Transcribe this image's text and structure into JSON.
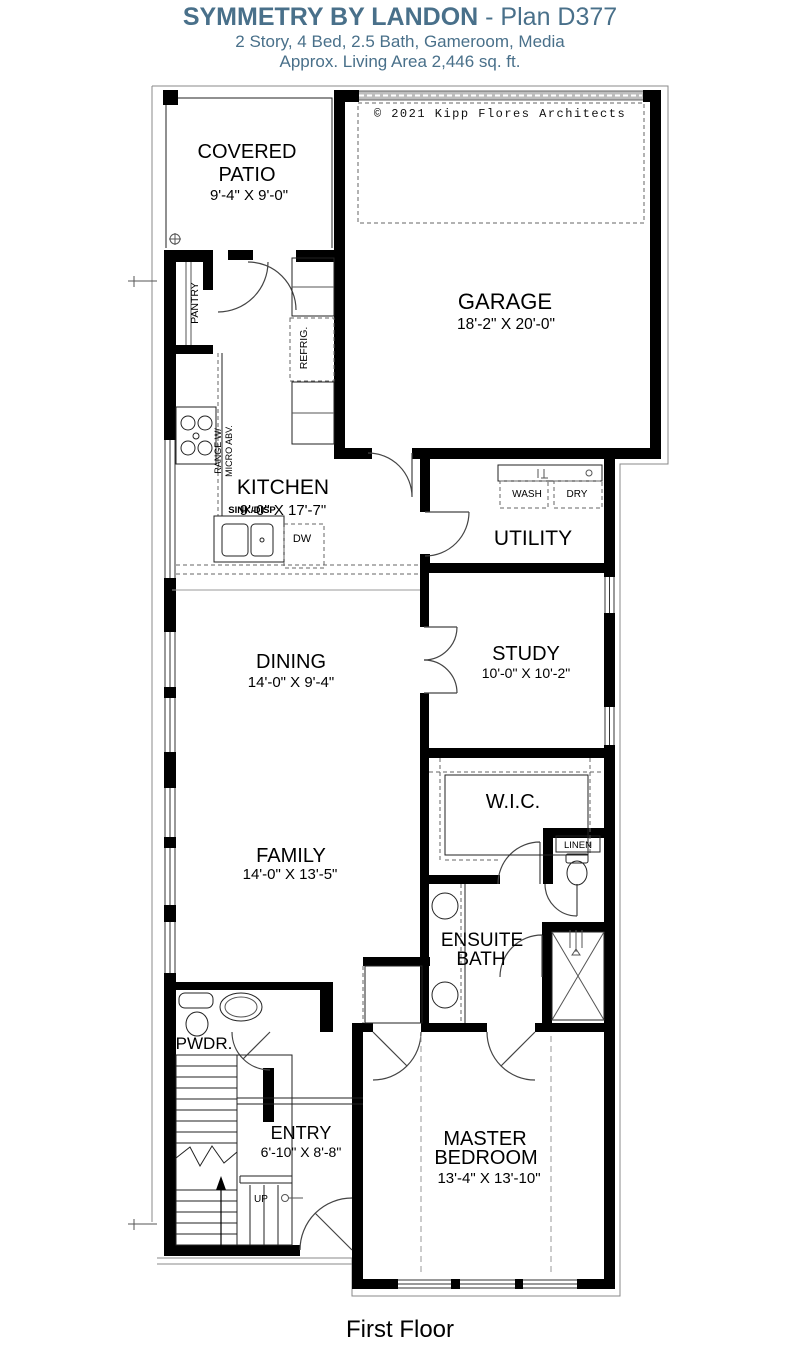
{
  "header": {
    "title_bold": "SYMMETRY BY LANDON",
    "title_rest": " - Plan D377",
    "subtitle": "2 Story, 4 Bed, 2.5 Bath, Gameroom, Media",
    "living_area": "Approx. Living Area 2,446 sq. ft."
  },
  "plan": {
    "copyright": "© 2021 Kipp Flores Architects",
    "floor_label": "First Floor",
    "rooms": {
      "covered_patio": {
        "line1": "COVERED",
        "line2": "PATIO",
        "dims": "9'-4\" X 9'-0\""
      },
      "garage": {
        "name": "GARAGE",
        "dims": "18'-2\" X 20'-0\""
      },
      "kitchen": {
        "name": "KITCHEN",
        "dims": "9'-0\" X 17'-7\""
      },
      "utility": {
        "name": "UTILITY"
      },
      "dining": {
        "name": "DINING",
        "dims": "14'-0\" X 9'-4\""
      },
      "study": {
        "name": "STUDY",
        "dims": "10'-0\" X 10'-2\""
      },
      "wic": {
        "name": "W.I.C."
      },
      "family": {
        "name": "FAMILY",
        "dims": "14'-0\" X 13'-5\""
      },
      "ensuite": {
        "line1": "ENSUITE",
        "line2": "BATH"
      },
      "powder": {
        "name": "PWDR."
      },
      "entry": {
        "name": "ENTRY",
        "dims": "6'-10\" X 8'-8\""
      },
      "master": {
        "line1": "MASTER",
        "line2": "BEDROOM",
        "dims": "13'-4\" X 13'-10\""
      }
    },
    "labels": {
      "pantry": "PANTRY",
      "refrig": "REFRIG.",
      "range1": "RANGE W/",
      "range2": "MICRO ABV.",
      "sink": "SINK/DISP",
      "dw": "DW",
      "wash": "WASH",
      "dry": "DRY",
      "linen": "LINEN",
      "up": "UP"
    }
  },
  "colors": {
    "title": "#49708a",
    "ink": "#000000"
  }
}
